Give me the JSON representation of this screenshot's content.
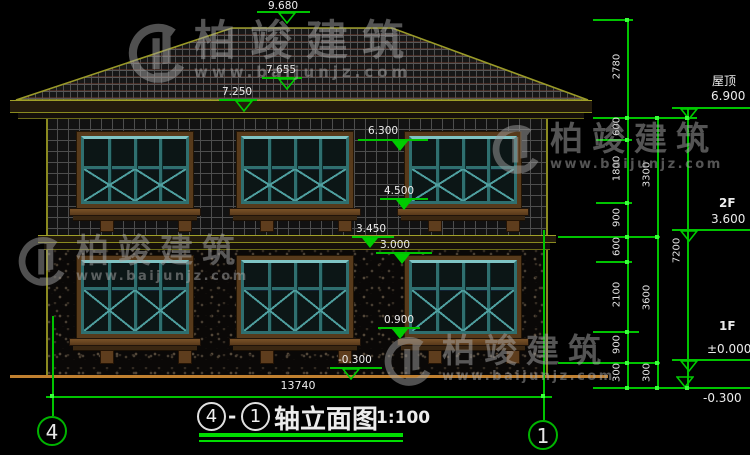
{
  "watermark": {
    "brand": "柏竣建筑",
    "url": "www.baijunjz.com"
  },
  "markers": {
    "ridge": "9.680",
    "slope_hi": "7.655",
    "slope_lo": "7.250",
    "w2_head": "6.300",
    "w2_sill": "4.500",
    "belt": "3.450",
    "f1_head": "3.000",
    "w1_sill": "0.900",
    "grade_mid": "-0.300",
    "roof_label": "屋顶",
    "roof_val": "6.900",
    "f2_label": "2F",
    "f2_val": "3.600",
    "f1_label": "1F",
    "f1_val": "±0.000",
    "grade_right": "-0.300"
  },
  "dims": {
    "col1": [
      "2780",
      "600",
      "1800",
      "900",
      "600",
      "2100",
      "900",
      "300"
    ],
    "col2": [
      "3300",
      "3600",
      "300"
    ],
    "col3": [
      "7200"
    ],
    "width": "13740"
  },
  "axis": {
    "left": "4",
    "right": "1"
  },
  "title": {
    "start": "4",
    "dash": "-",
    "end": "1",
    "name": "轴立面图",
    "scale": "1:100"
  }
}
